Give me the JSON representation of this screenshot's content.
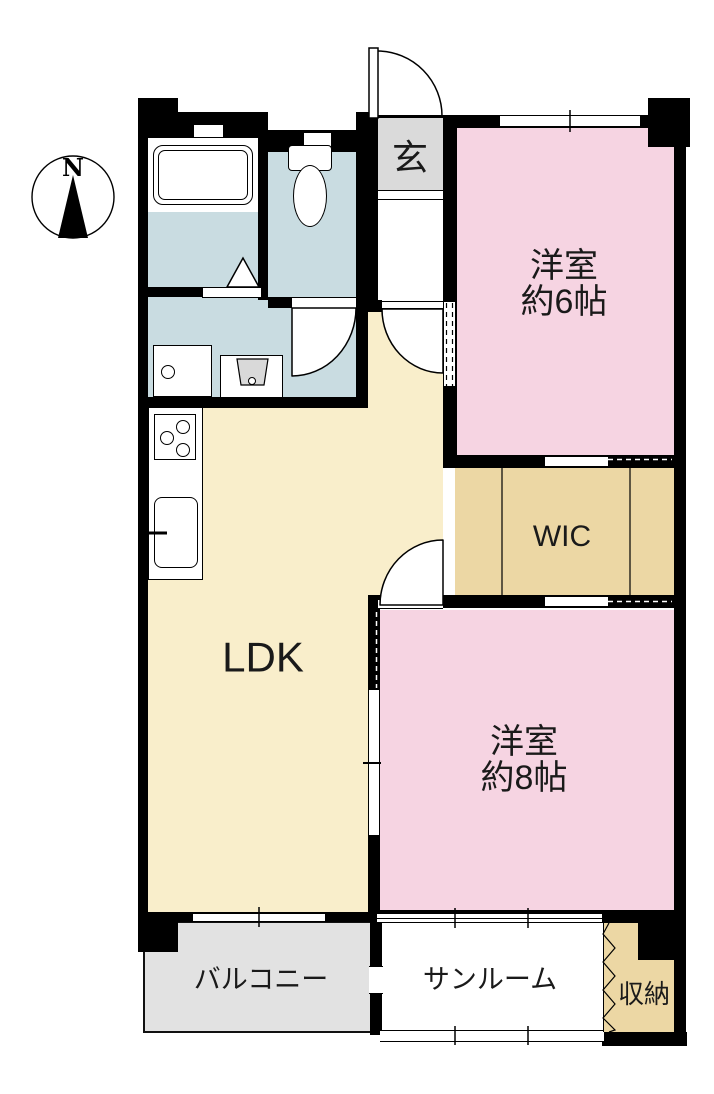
{
  "plan_title": "2LDK floor plan",
  "compass": {
    "north_label": "N"
  },
  "rooms": {
    "genkan": {
      "label": "玄"
    },
    "western6": {
      "label_line1": "洋室",
      "label_line2": "約6帖"
    },
    "wic": {
      "label": "WIC"
    },
    "ldk": {
      "label": "LDK"
    },
    "western8": {
      "label_line1": "洋室",
      "label_line2": "約8帖"
    },
    "balcony": {
      "label": "バルコニー"
    },
    "sunroom": {
      "label": "サンルーム"
    },
    "storage": {
      "label": "収納"
    }
  },
  "colors": {
    "wall": "#000000",
    "pink": "#f6d4e2",
    "cream": "#f9eecb",
    "tan": "#ecd7a4",
    "blue": "#c9dce1",
    "genkan": "#dadada",
    "balcony": "#e2e2e2",
    "fixture": "#d9d9d9"
  }
}
